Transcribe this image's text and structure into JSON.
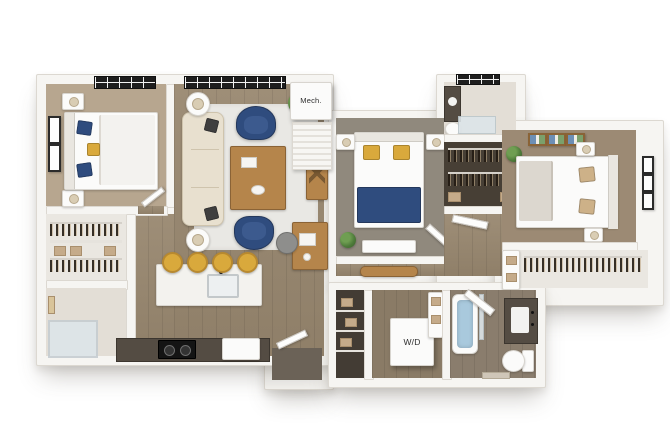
{
  "labels": {
    "mech_closet": "Mech.",
    "washer_dryer": "W/D"
  },
  "palette": {
    "background": "#ffffff",
    "wall": "#f6f5f2",
    "wall_edge": "#dcd8d1",
    "wood_floor": "#98876f",
    "wood_floor_dark": "#8a7b66",
    "carpet_beige": "#b7a68f",
    "carpet_gray": "#90897d",
    "carpet_brown": "#9c8a74",
    "accent_navy": "#2f4c7e",
    "accent_yellow": "#d9a93c",
    "sofa_cream": "#e8e0cf",
    "table_wood": "#b5854b",
    "rug_light": "#e9e8e4",
    "counter_dark": "#544c43",
    "closet_dark": "#473f35",
    "water_blue": "#a9c9dd",
    "plant_green": "#4e7b3a",
    "window_black": "#1e1e1e",
    "pillow_tan": "#cdb188",
    "tile_light": "#e3ded6"
  },
  "rooms": {
    "bedroom_1": {
      "furniture": [
        "bed",
        "nightstands",
        "lamps",
        "window",
        "wall-art"
      ]
    },
    "living_room": {
      "furniture": [
        "sofa",
        "navy-armchairs",
        "coffee-table",
        "rug",
        "side-tables",
        "desk",
        "console-table",
        "plant",
        "windows"
      ]
    },
    "kitchen": {
      "furniture": [
        "island",
        "sink",
        "bar-stools",
        "counter",
        "cooktop"
      ]
    },
    "bedroom_2": {
      "furniture": [
        "bed",
        "nightstands",
        "bench",
        "plant"
      ]
    },
    "bedroom_3": {
      "furniture": [
        "bed",
        "nightstands",
        "wall-art",
        "plant",
        "closet"
      ]
    },
    "bathrooms": {
      "fixtures": [
        "shower",
        "bathtub",
        "vanity",
        "toilet"
      ]
    },
    "utility": {
      "items": [
        "mech-closet",
        "washer-dryer",
        "pantry-shelves",
        "walk-in-closets"
      ]
    }
  }
}
